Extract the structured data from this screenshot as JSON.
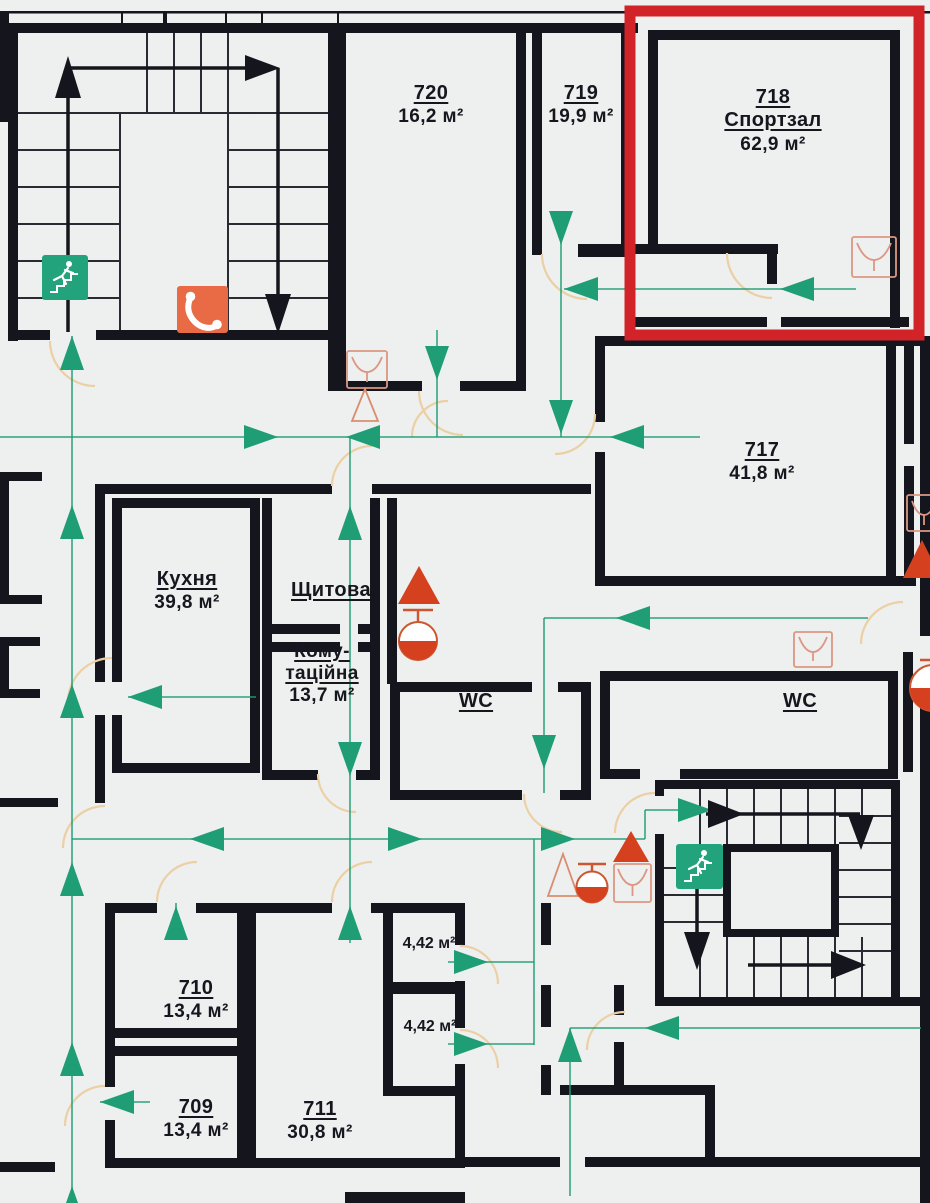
{
  "title": "Evacuation floor plan (7th floor fragment)",
  "colors": {
    "bg": "#edf0ee",
    "wall": "#15151e",
    "route": "#1f9d75",
    "door": "#eccfa4",
    "accent": "#d22329",
    "sign_green": "#22a37c",
    "sign_orange": "#e96b46",
    "symbol_red": "#d5401f",
    "text": "#16161f"
  },
  "rooms": {
    "r720": {
      "number": "720",
      "area": "16,2 м²"
    },
    "r719": {
      "number": "719",
      "area": "19,9 м²"
    },
    "r718": {
      "number": "718",
      "name": "Спортзал",
      "area": "62,9 м²"
    },
    "r717": {
      "number": "717",
      "area": "41,8 м²"
    },
    "kitchen": {
      "name": "Кухня",
      "area": "39,8 м²"
    },
    "panel": {
      "name": "Щитова"
    },
    "comm": {
      "name_line1": "Кому-",
      "name_line2": "таційна",
      "area": "13,7 м²"
    },
    "wc1": {
      "name": "WC"
    },
    "wc2": {
      "name": "WC"
    },
    "r710": {
      "number": "710",
      "area": "13,4 м²"
    },
    "r709": {
      "number": "709",
      "area": "13,4 м²"
    },
    "r711": {
      "number": "711",
      "area": "30,8 м²"
    },
    "small1": {
      "area": "4,42 м²"
    },
    "small2": {
      "area": "4,42 м²"
    }
  },
  "symbols": {
    "exit_sign": "emergency-exit-via-stairs",
    "phone_sign": "emergency-phone",
    "extinguisher": "fire-extinguisher",
    "hose_reel": "fire-hose-reel",
    "call_point": "manual-call-point",
    "highlight": "room-718-highlight"
  }
}
